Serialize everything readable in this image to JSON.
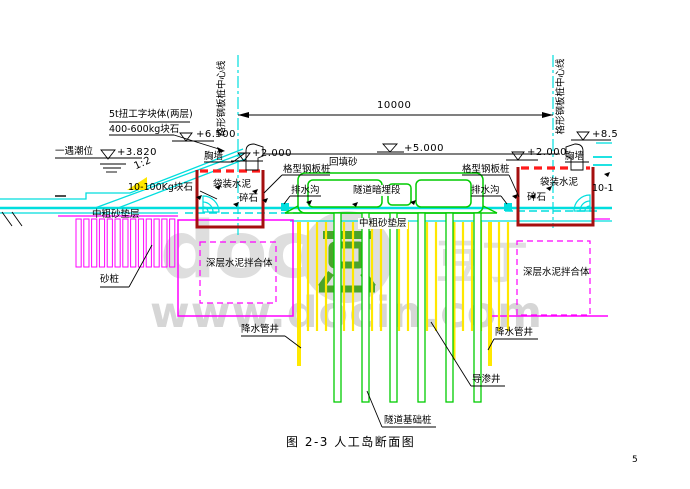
{
  "title": {
    "figure_caption": "图 2-3  人工岛断面图",
    "page_number": "5"
  },
  "dimension": {
    "span_label": "10000"
  },
  "centerlines": {
    "left_label": "格形钢板桩中心线",
    "right_label": "格形钢板桩中心线"
  },
  "elevations": {
    "crest_left": "+6.500",
    "tide_label": "一遇潮位",
    "tide_value": "+3.820",
    "parapet_left": "+2.000",
    "island_top": "+5.000",
    "parapet_right": "+2.000",
    "crest_right": "+8.5"
  },
  "labels": {
    "armor_blocks_line1": "5t扭工字块体(两层)",
    "armor_blocks_line2": "400-600kg块石",
    "slope_ratio": "1:2",
    "rock_left": "10-100Kg块石",
    "rock_right": "10-100Kg块石",
    "parapet_wall_left": "胸墙",
    "parapet_wall_right": "胸墙",
    "bagged_cement_left": "袋装水泥",
    "gravel_left": "碎石",
    "bagged_cement_right": "袋装水泥",
    "gravel_right": "碎石",
    "cell_sheet_pile_left": "格型钢板桩",
    "cell_sheet_pile_right": "格型钢板桩",
    "drainage_ditch_left": "排水沟",
    "drainage_ditch_right": "排水沟",
    "backfill_sand": "回填砂",
    "tunnel_buried_section": "隧道暗埋段",
    "sand_cushion_left": "中粗砂垫层",
    "sand_cushion_center": "中粗砂垫层",
    "sand_piles": "砂桩",
    "deep_cement_mix_left": "深层水泥拌合体",
    "deep_cement_mix_right": "深层水泥拌合体",
    "dewatering_well_left": "降水管井",
    "dewatering_well_right": "降水管井",
    "seepage_well": "导渗井",
    "tunnel_foundation_piles": "隧道基础桩"
  },
  "watermark": {
    "big_text": "doc",
    "cn_text": "豆丁",
    "url_text": "www.docin.com",
    "logo_green": "#4aa32a",
    "gray": "#dedede"
  },
  "colors": {
    "cyan_lines": "#00dede",
    "magenta_lines": "#ff00ff",
    "yellow_piles": "#ffe800",
    "green_tunnel": "#00cc00",
    "dark_red_box": "#a50f0f",
    "red_dashed": "#ff1a1a",
    "black": "#000000"
  }
}
